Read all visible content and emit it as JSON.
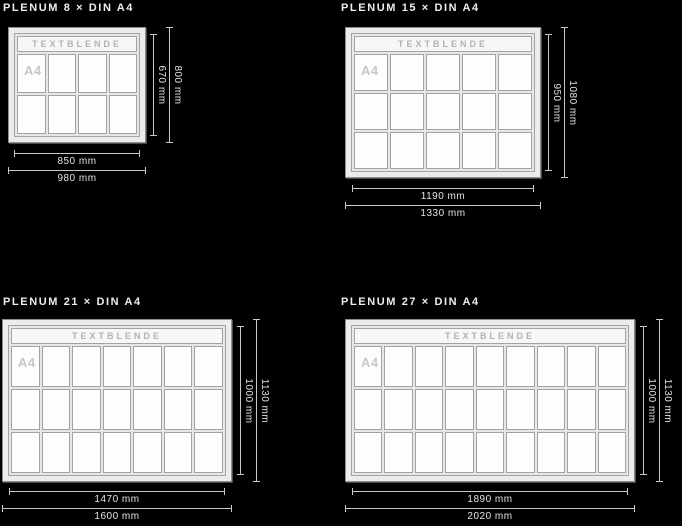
{
  "page": {
    "background": "#000000",
    "description": "Technical size diagram of PLENUM showcase boards"
  },
  "colors": {
    "dimension_line": "#c9c9c9",
    "dimension_label": "#e2e2e2",
    "title_text": "#ededed",
    "frame_fill": "#ececec",
    "cell_fill": "#fdfdfd",
    "cell_border": "#a3a3a3",
    "textblende_text": "#b2b2b2",
    "a4_text": "#c7c7c7"
  },
  "panels": [
    {
      "title": "PLENUM 8 × DIN A4",
      "textblende": "TEXTBLENDE",
      "cell_label": "A4",
      "grid": {
        "cols": 4,
        "rows": 2
      },
      "dimensions": {
        "visible_height": "670 mm",
        "outer_height": "800 mm",
        "visible_width": "850 mm",
        "outer_width": "980 mm"
      }
    },
    {
      "title": "PLENUM 15 × DIN A4",
      "textblende": "TEXTBLENDE",
      "cell_label": "A4",
      "grid": {
        "cols": 5,
        "rows": 3
      },
      "dimensions": {
        "visible_height": "950 mm",
        "outer_height": "1080 mm",
        "visible_width": "1190 mm",
        "outer_width": "1330 mm"
      }
    },
    {
      "title": "PLENUM 21 × DIN A4",
      "textblende": "TEXTBLENDE",
      "cell_label": "A4",
      "grid": {
        "cols": 7,
        "rows": 3
      },
      "dimensions": {
        "visible_height": "1000 mm",
        "outer_height": "1130 mm",
        "visible_width": "1470 mm",
        "outer_width": "1600 mm"
      }
    },
    {
      "title": "PLENUM 27 × DIN A4",
      "textblende": "TEXTBLENDE",
      "cell_label": "A4",
      "grid": {
        "cols": 9,
        "rows": 3
      },
      "dimensions": {
        "visible_height": "1000 mm",
        "outer_height": "1130 mm",
        "visible_width": "1890 mm",
        "outer_width": "2020 mm"
      }
    }
  ]
}
